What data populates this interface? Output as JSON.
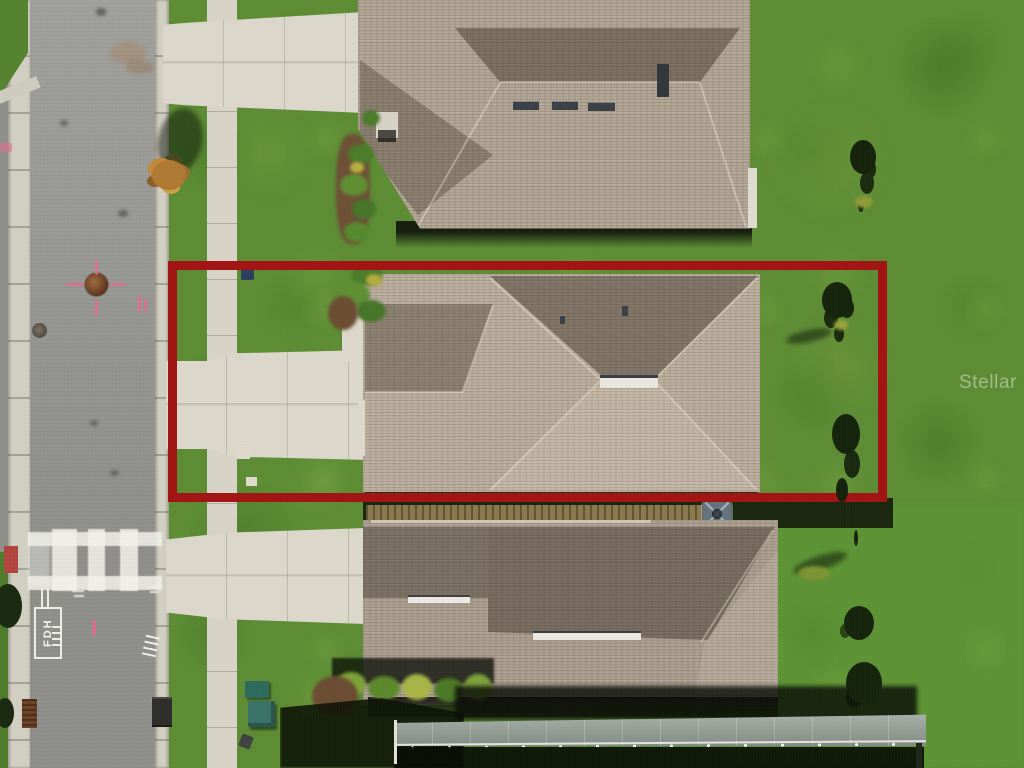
{
  "watermark": {
    "text": "Stellar MLS",
    "color": "#ffffff"
  },
  "boundary_annotation": {
    "shape": "rectangle",
    "purpose": "property-lot-outline",
    "color": "#a31414",
    "stroke_px": 9
  },
  "road_markings": {
    "fdh_label": "FDH",
    "paint_color": "#f2f1ea",
    "survey_paint_color": "#e06e8e"
  },
  "palette": {
    "grass": "#5d8d35",
    "grass_bright": "#63a437",
    "asphalt": "#9a9a97",
    "curb": "#d2cfc3",
    "sidewalk": "#d8d4c8",
    "concrete": "#dcd8cb",
    "roof_top_house": "#b3a695",
    "roof_middle_house": "#bcaf9e",
    "roof_bottom_house": "#ab9f90",
    "roof_shadow": "#6f6556",
    "mulch": "#6b4e33",
    "shrub_green": "#5f9032",
    "shrub_yellow": "#b3ad3f",
    "fence_tan": "#8a7a4e",
    "enclosure_sage": "#95a096",
    "ac_unit_gray": "#64737d",
    "utility_box_teal": "#2f6b5d",
    "manhole_rust": "#7c4a28",
    "tree_dark": "#16240c",
    "autumn_tree_orange": "#b07a33",
    "shadow_dark": "#121a0a",
    "crosswalk_white": "#f3f2ec"
  }
}
